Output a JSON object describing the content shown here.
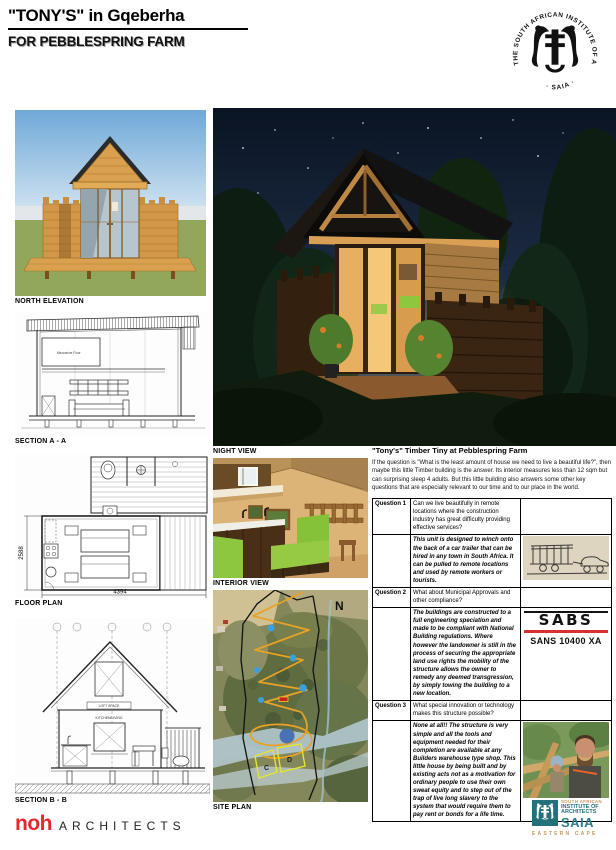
{
  "header": {
    "title_main": "\"TONY'S\"",
    "title_rest": " in Gqeberha",
    "subtitle": "FOR PEBBLESPRING FARM",
    "stamp_ring": "THE SOUTH AFRICAN INSTITUTE OF ARCHITECTS",
    "stamp_caption": "· SAIA ·"
  },
  "panels": {
    "north_elevation": {
      "label": "NORTH ELEVATION"
    },
    "section_a": {
      "label": "SECTION A - A",
      "mezzanine_note": "Mezzanine Floor"
    },
    "floor_plan": {
      "label": "FLOOR PLAN",
      "dim_width": "4394",
      "dim_height": "2588"
    },
    "section_b": {
      "label": "SECTION B - B",
      "loft_note": "LOFT SPACE",
      "kitchen_note": "KITCHEN/LIVING"
    },
    "night_view": {
      "label": "NIGHT VIEW"
    },
    "interior_view": {
      "label": "INTERIOR VIEW"
    },
    "site_plan": {
      "label": "SITE PLAN",
      "north_marker": "N",
      "zone_c": "C",
      "zone_d": "D"
    }
  },
  "article": {
    "title": "\"Tony's\" Timber Tiny at Pebblespring Farm",
    "intro": "If the question is \"What is the least amount of house we need to live a beautiful life?\", then maybe this little Timber building is the answer. Its interior measures less than 12 sqm but can surprising sleep 4 adults. But this little building also answers some other key questions that are especially relevant to our time and to our place in the world.",
    "qa": [
      {
        "label": "Question 1",
        "question": "Can we live beautifully in remote locations where the construction industry has great difficulty providing effective services?",
        "answer": "This unit is designed to winch onto the back of a car trailer that can be hired in any town in South Africa. It can be pulled to remote locations and used by remote workers or tourists.",
        "figure": "trailer-sketch"
      },
      {
        "label": "Question 2",
        "question": "What about Municipal Approvals and other compliance?",
        "answer": "The buildings are constructed to a full engineering speciation and made to be compliant with National Building regulations. Where however the landowner is still in the process of securing the appropriate land use rights the mobility of the structure allows the owner to remedy any deemed transgression, by simply towing the building to a new location.",
        "figure": "sabs-mark",
        "sabs_brand": "SABS",
        "sabs_standard": "SANS 10400 XA"
      },
      {
        "label": "Question 3",
        "question": "What special innovation or technology makes this structure possible?",
        "answer": "None at all!!  The structure is very simple and all the tools and equipment needed for their completion are available at any Builders warehouse type shop. This little house by being built and by existing acts not as a motivation for ordinary people to use their own sweat equity and to step out of the trap of live long slavery to the system that would require them to pay rent or bonds for a life time.",
        "figure": "builder-photo"
      }
    ]
  },
  "footer": {
    "noh": "noh",
    "architects": "ARCHITECTS",
    "saia_ec": {
      "line1": "SOUTH AFRICAN",
      "line2": "INSTITUTE OF",
      "line3": "ARCHITECTS",
      "acronym": "SAIA",
      "region": "EASTERN CAPE"
    }
  },
  "colors": {
    "accent_red_text": "#dd0000",
    "noh_red": "#e8262d",
    "sabs_bar_red": "#d93030",
    "saia_teal": "#26707b",
    "lime_sofa": "#8dc63f",
    "path_orange": "#e8a225"
  }
}
